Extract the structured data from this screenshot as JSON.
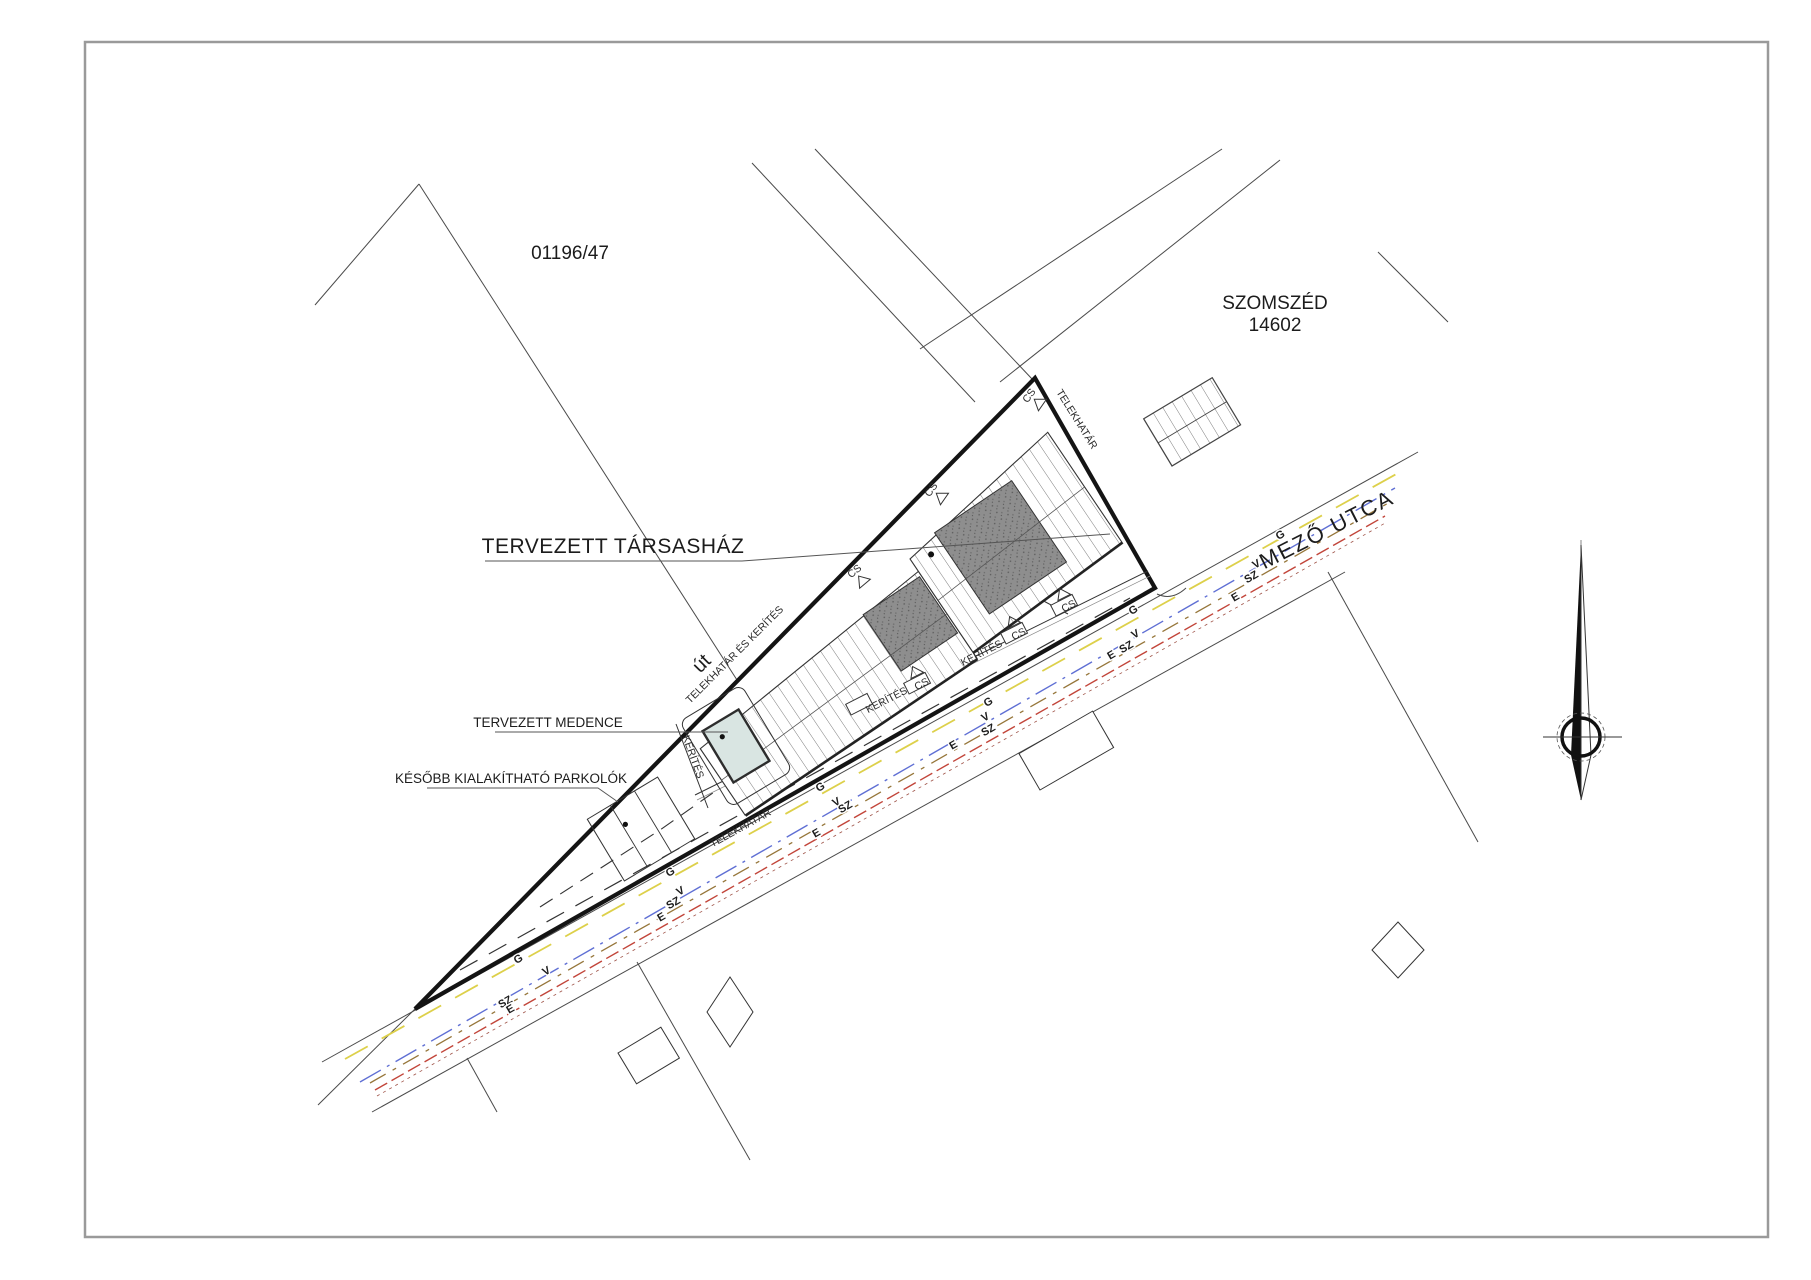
{
  "drawing": {
    "parcel_number": "01196/47",
    "neighbor": {
      "name": "SZOMSZÉD",
      "number": "14602"
    },
    "title": "TERVEZETT TÁRSASHÁZ",
    "street_name": "MEZŐ UTCA",
    "pool_label": "TERVEZETT MEDENCE",
    "parking_label": "KÉSŐBB KIALAKÍTHATÓ PARKOLÓK",
    "road_label": "út",
    "boundary_fence_label": "TELEKHATÁR ÉS KERÍTÉS",
    "boundary_label": "TELEKHATÁR",
    "fence_label": "KERÍTÉS",
    "drain_label": "CS"
  },
  "utilities": {
    "gas": {
      "label": "G",
      "color": "#ddd04a"
    },
    "water": {
      "label": "V",
      "color": "#5f6fd4"
    },
    "sewer": {
      "label": "SZ",
      "color": "#96763a"
    },
    "electric": {
      "label": "E",
      "color": "#c2453a"
    }
  },
  "colors": {
    "boundary": "#141414",
    "pool_fill": "#d9e5e2",
    "roof_dark": "#8e8e8e",
    "page_border": "#9a9a9a"
  }
}
